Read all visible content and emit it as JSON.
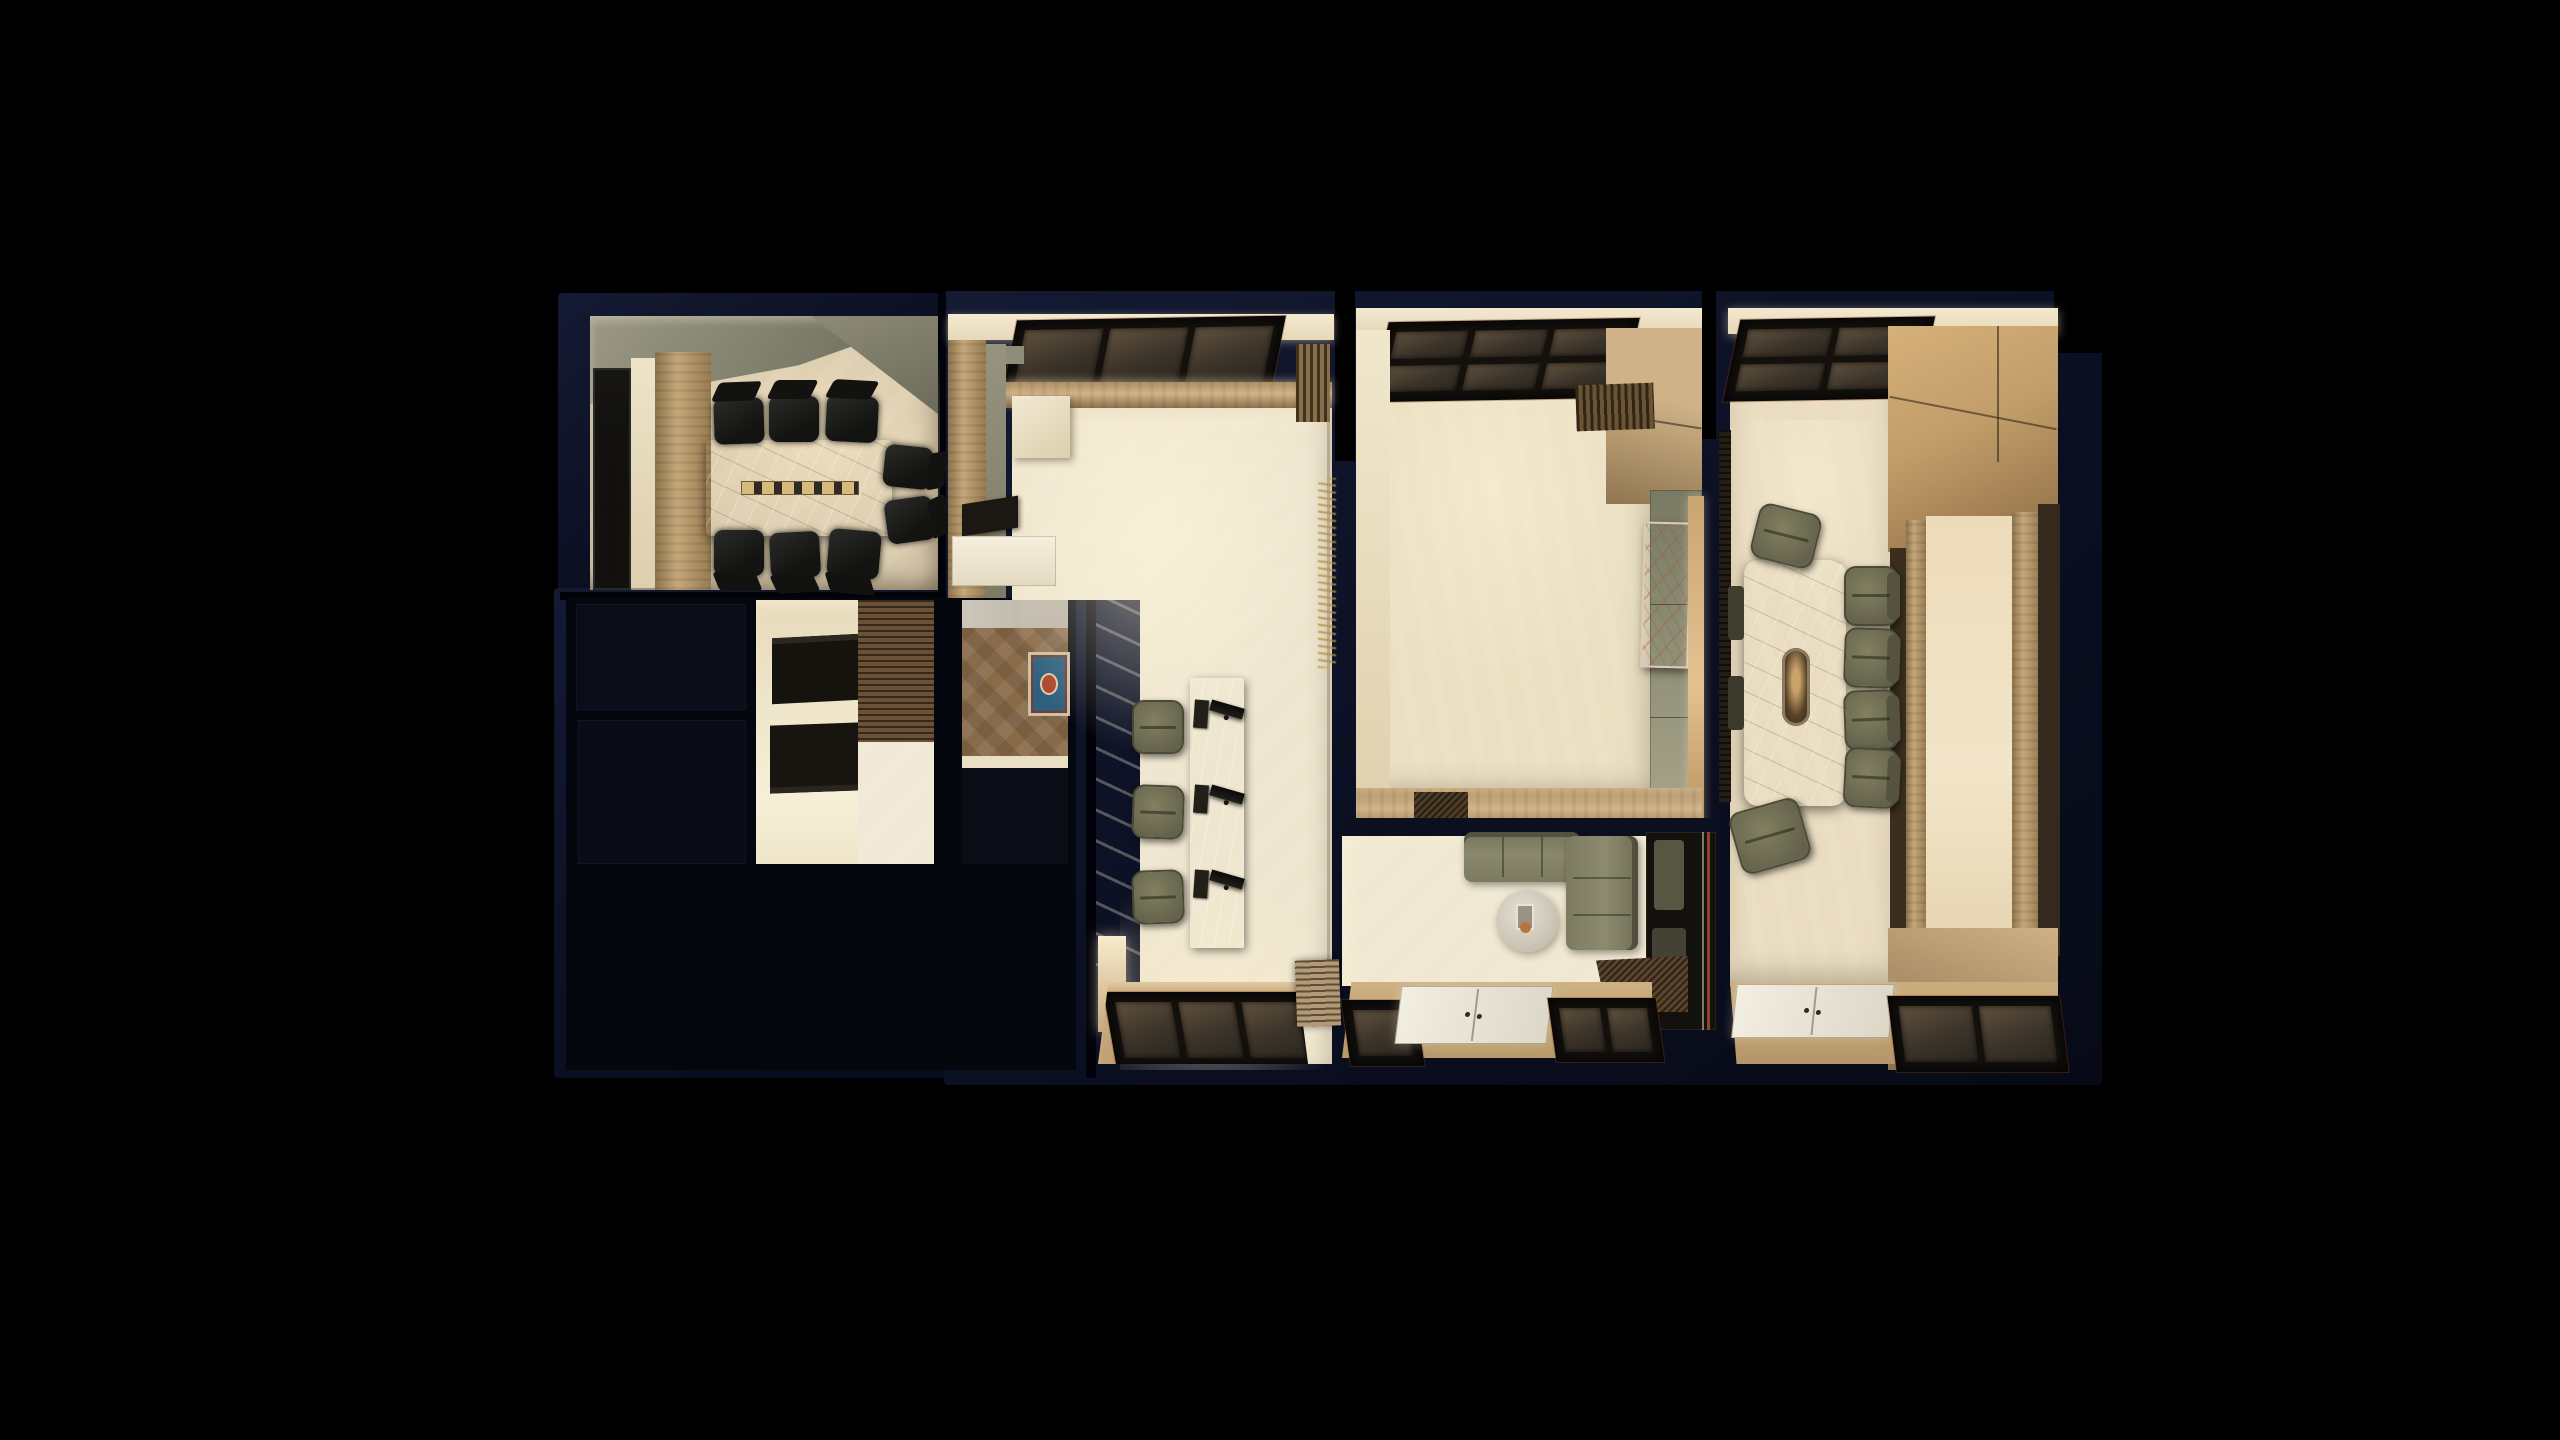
{
  "scene": {
    "description": "Top-down 3D architectural render of an office interior floor plan glowing against a black background",
    "background": "#000000"
  },
  "palette": {
    "canvas-black": "#000000",
    "wall-navy": "#11162c",
    "wall-navy-deep": "#080b18",
    "floor-ivory": "#efe6cf",
    "floor-tan": "#d8c9ab",
    "floor-cream": "#ebdfc2",
    "wood-light": "#d8b684",
    "wood-mid": "#b08a58",
    "wood-deep": "#77603f",
    "slat-brown": "#5f4a2e",
    "sage": "#8f8d79",
    "sage-green": "#82836c",
    "olive": "#71705a",
    "chair-black": "#1a1a18",
    "marble-grey": "#bdb5a6",
    "glass-dark": "#1c1914",
    "glass-pane": "#514533",
    "carpet-brown": "#8a6b49",
    "rug-blue": "#2e5f7e",
    "door-white": "#eae6da",
    "gold": "#b28d45",
    "glow-warm": "#ffe9c2"
  },
  "rooms": {
    "conference": {
      "label": "Conference room with stone table and eight black chairs"
    },
    "store_a": {
      "label": "Unlit room"
    },
    "store_b": {
      "label": "Unlit room"
    },
    "shelf_room": {
      "label": "Storage room with dark wall niches and slatted screen"
    },
    "prayer": {
      "label": "Prayer room with brown carpet and blue rug"
    },
    "back_area": {
      "label": "Unlit back-of-house area"
    },
    "reception": {
      "label": "Reception open area with workstation counter and skylights"
    },
    "hall": {
      "label": "Main hall with skylight, green feature wall and marble artwork"
    },
    "lounge": {
      "label": "Lounge with L-shaped olive sofa and round coffee table"
    },
    "executive": {
      "label": "Executive meeting room with long marble table and olive chairs"
    }
  },
  "furniture": {
    "conference_table": {
      "label": "Marble conference table with power strip"
    },
    "office_chair": {
      "label": "Black office chair"
    },
    "display_case": {
      "label": "Dark glass display case"
    },
    "reception_counter": {
      "label": "Marble workstation counter with three monitors"
    },
    "task_chair": {
      "label": "Olive task chair"
    },
    "prayer_rug": {
      "label": "Blue ornamental prayer rug"
    },
    "sofa": {
      "label": "L-shaped olive sectional sofa"
    },
    "coffee_table": {
      "label": "Round white coffee table with tray"
    },
    "mirror": {
      "label": "Mirror panel reflecting the lounge"
    },
    "artwork": {
      "label": "Marble wall artwork"
    },
    "executive_table": {
      "label": "Long marble table with oval light cove"
    },
    "entrance_door": {
      "label": "White double entrance door"
    },
    "skylight": {
      "label": "Dark glazed skylight"
    },
    "bench": {
      "label": "Slatted wood bench"
    },
    "walkway": {
      "label": "Slatted wood walkway"
    },
    "gold_screen": {
      "label": "Glass screen with gold branch pattern"
    }
  }
}
